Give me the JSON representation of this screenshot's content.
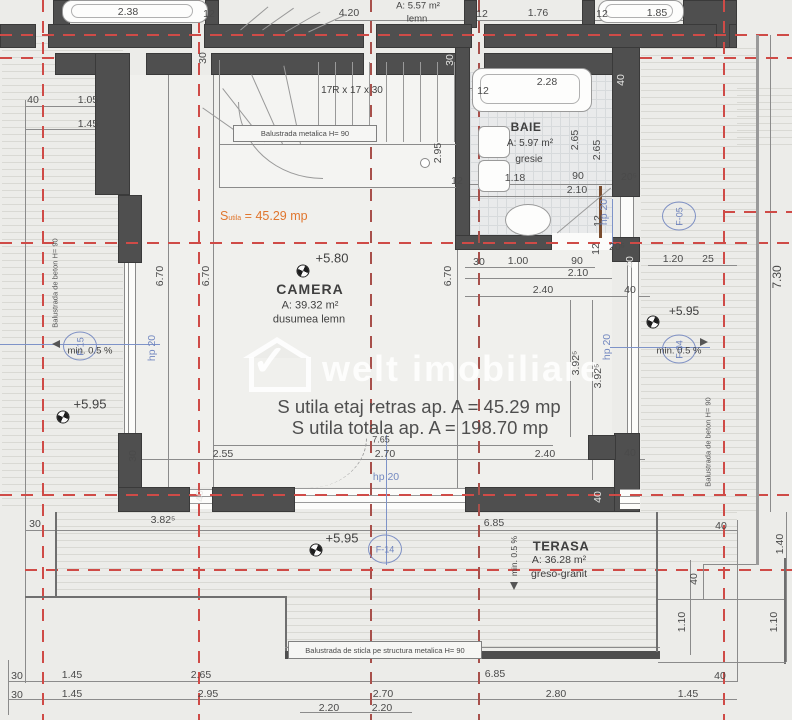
{
  "watermark": {
    "brand": "welt imobiliare"
  },
  "colors": {
    "wall": "#4f4f4f",
    "axis_red": "#cf4b47",
    "annotation_blue": "#7388c0",
    "accent_orange": "#e0762e",
    "background": "#ecece9"
  },
  "rooms": {
    "camera": {
      "name": "CAMERA",
      "area": "A: 39.32 m²",
      "finish": "dusumea lemn",
      "level": "+5.80"
    },
    "baie": {
      "name": "BAIE",
      "area": "A: 5.97 m²",
      "finish": "gresie"
    },
    "terasa": {
      "name": "TERASA",
      "area": "A: 36.28 m²",
      "finish": "greso-granit"
    }
  },
  "upper_room": {
    "area": "A: 5.57 m²",
    "finish": "lemn"
  },
  "summary": {
    "su_s": "S",
    "su_sub": "utila",
    "su_val": "= 45.29 mp",
    "line1": "S utila etaj retras ap. A = 45.29 mp",
    "line2": "S utila totala ap. A = 198.70 mp"
  },
  "stairs": {
    "spec": "17R x 17 x 30",
    "railing": "Balustrada metalica H= 90"
  },
  "railings": {
    "left": "Balustrada de beton H= 90",
    "right": "Balustrada de beton H= 90",
    "glass": "Balustrada de sticla pe structura metalica H= 90"
  },
  "slopes": {
    "left": "min. 0.5 %",
    "right": "min. 0.5 %",
    "terasa": "min. 0.5 %"
  },
  "levels": {
    "left": "+5.95",
    "right": "+5.95",
    "terasa": "+5.95"
  },
  "tags": {
    "f05": "F-05",
    "f15": "F-15",
    "f04": "F-04",
    "f14": "F-14"
  },
  "dim_labels": [
    {
      "t": "2.38",
      "x": 128,
      "y": 12
    },
    {
      "t": "12",
      "x": 209,
      "y": 14
    },
    {
      "t": "4.20",
      "x": 349,
      "y": 13
    },
    {
      "t": "12",
      "x": 482,
      "y": 14
    },
    {
      "t": "1.76",
      "x": 538,
      "y": 13
    },
    {
      "t": "12",
      "x": 602,
      "y": 14
    },
    {
      "t": "1.85",
      "x": 657,
      "y": 13
    },
    {
      "t": "40",
      "x": 33,
      "y": 100
    },
    {
      "t": "1.05",
      "x": 88,
      "y": 100
    },
    {
      "t": "1.45",
      "x": 88,
      "y": 124
    },
    {
      "t": "30",
      "x": 203,
      "y": 58,
      "r": 1
    },
    {
      "t": "30",
      "x": 450,
      "y": 60,
      "r": 1,
      "w": 1
    },
    {
      "t": "6.70",
      "x": 160,
      "y": 276,
      "r": 1
    },
    {
      "t": "6.70",
      "x": 206,
      "y": 276,
      "r": 1
    },
    {
      "t": "6.70",
      "x": 448,
      "y": 276,
      "r": 1
    },
    {
      "t": "2.95",
      "x": 438,
      "y": 153,
      "r": 1
    },
    {
      "t": "12",
      "x": 457,
      "y": 181
    },
    {
      "t": "2.28",
      "x": 547,
      "y": 82
    },
    {
      "t": "12",
      "x": 483,
      "y": 91
    },
    {
      "t": "40",
      "x": 621,
      "y": 80,
      "r": 1,
      "w": 1
    },
    {
      "t": "1.18",
      "x": 515,
      "y": 178
    },
    {
      "t": "90",
      "x": 578,
      "y": 176
    },
    {
      "t": "20⁵",
      "x": 629,
      "y": 177
    },
    {
      "t": "2.10",
      "x": 577,
      "y": 190
    },
    {
      "t": "2.65",
      "x": 575,
      "y": 140,
      "r": 1
    },
    {
      "t": "2.65",
      "x": 597,
      "y": 150,
      "r": 1
    },
    {
      "t": "12",
      "x": 598,
      "y": 221,
      "r": 1
    },
    {
      "t": "12",
      "x": 596,
      "y": 249,
      "r": 1
    },
    {
      "t": "20⁵",
      "x": 617,
      "y": 247
    },
    {
      "t": "40",
      "x": 630,
      "y": 262,
      "r": 1,
      "w": 1
    },
    {
      "t": "30",
      "x": 479,
      "y": 262
    },
    {
      "t": "1.00",
      "x": 518,
      "y": 261
    },
    {
      "t": "90",
      "x": 577,
      "y": 261
    },
    {
      "t": "2.10",
      "x": 578,
      "y": 273
    },
    {
      "t": "2.40",
      "x": 543,
      "y": 290
    },
    {
      "t": "40",
      "x": 630,
      "y": 290
    },
    {
      "t": "1.20",
      "x": 673,
      "y": 259
    },
    {
      "t": "25",
      "x": 708,
      "y": 259
    },
    {
      "t": "7.30",
      "x": 777,
      "y": 277,
      "r": 1,
      "fs": 12
    },
    {
      "t": "3.92⁵",
      "x": 576,
      "y": 363,
      "r": 1
    },
    {
      "t": "3.92⁵",
      "x": 598,
      "y": 376,
      "r": 1
    },
    {
      "t": "7.65",
      "x": 381,
      "y": 440,
      "fs": 9
    },
    {
      "t": "2.55",
      "x": 223,
      "y": 454
    },
    {
      "t": "2.70",
      "x": 385,
      "y": 454
    },
    {
      "t": "2.40",
      "x": 545,
      "y": 454
    },
    {
      "t": "30",
      "x": 133,
      "y": 456,
      "r": 1
    },
    {
      "t": "40",
      "x": 200,
      "y": 496,
      "r": 1,
      "w": 1
    },
    {
      "t": "40",
      "x": 598,
      "y": 497,
      "r": 1,
      "w": 1
    },
    {
      "t": "40",
      "x": 630,
      "y": 453
    },
    {
      "t": "30",
      "x": 35,
      "y": 524
    },
    {
      "t": "3.82⁵",
      "x": 163,
      "y": 520
    },
    {
      "t": "6.85",
      "x": 494,
      "y": 523
    },
    {
      "t": "40",
      "x": 721,
      "y": 526
    },
    {
      "t": "40",
      "x": 694,
      "y": 579,
      "r": 1
    },
    {
      "t": "1.40",
      "x": 780,
      "y": 544,
      "r": 1
    },
    {
      "t": "1.10",
      "x": 682,
      "y": 622,
      "r": 1
    },
    {
      "t": "1.10",
      "x": 774,
      "y": 622,
      "r": 1
    },
    {
      "t": "30",
      "x": 17,
      "y": 676
    },
    {
      "t": "1.45",
      "x": 72,
      "y": 675
    },
    {
      "t": "2.65",
      "x": 201,
      "y": 675
    },
    {
      "t": "6.85",
      "x": 495,
      "y": 674
    },
    {
      "t": "40",
      "x": 720,
      "y": 676
    },
    {
      "t": "30",
      "x": 17,
      "y": 695
    },
    {
      "t": "1.45",
      "x": 72,
      "y": 694
    },
    {
      "t": "2.95",
      "x": 208,
      "y": 694
    },
    {
      "t": "2.70",
      "x": 383,
      "y": 694
    },
    {
      "t": "2.80",
      "x": 556,
      "y": 694
    },
    {
      "t": "1.45",
      "x": 688,
      "y": 694
    },
    {
      "t": "2.20",
      "x": 329,
      "y": 708
    },
    {
      "t": "2.20",
      "x": 382,
      "y": 708
    },
    {
      "t": "hp 20",
      "x": 152,
      "y": 348,
      "r": 1,
      "b": 1
    },
    {
      "t": "hp 20",
      "x": 604,
      "y": 212,
      "r": 1,
      "b": 1
    },
    {
      "t": "hp 20",
      "x": 607,
      "y": 347,
      "r": 1,
      "b": 1
    },
    {
      "t": "hp 20",
      "x": 386,
      "y": 477,
      "b": 1
    }
  ]
}
